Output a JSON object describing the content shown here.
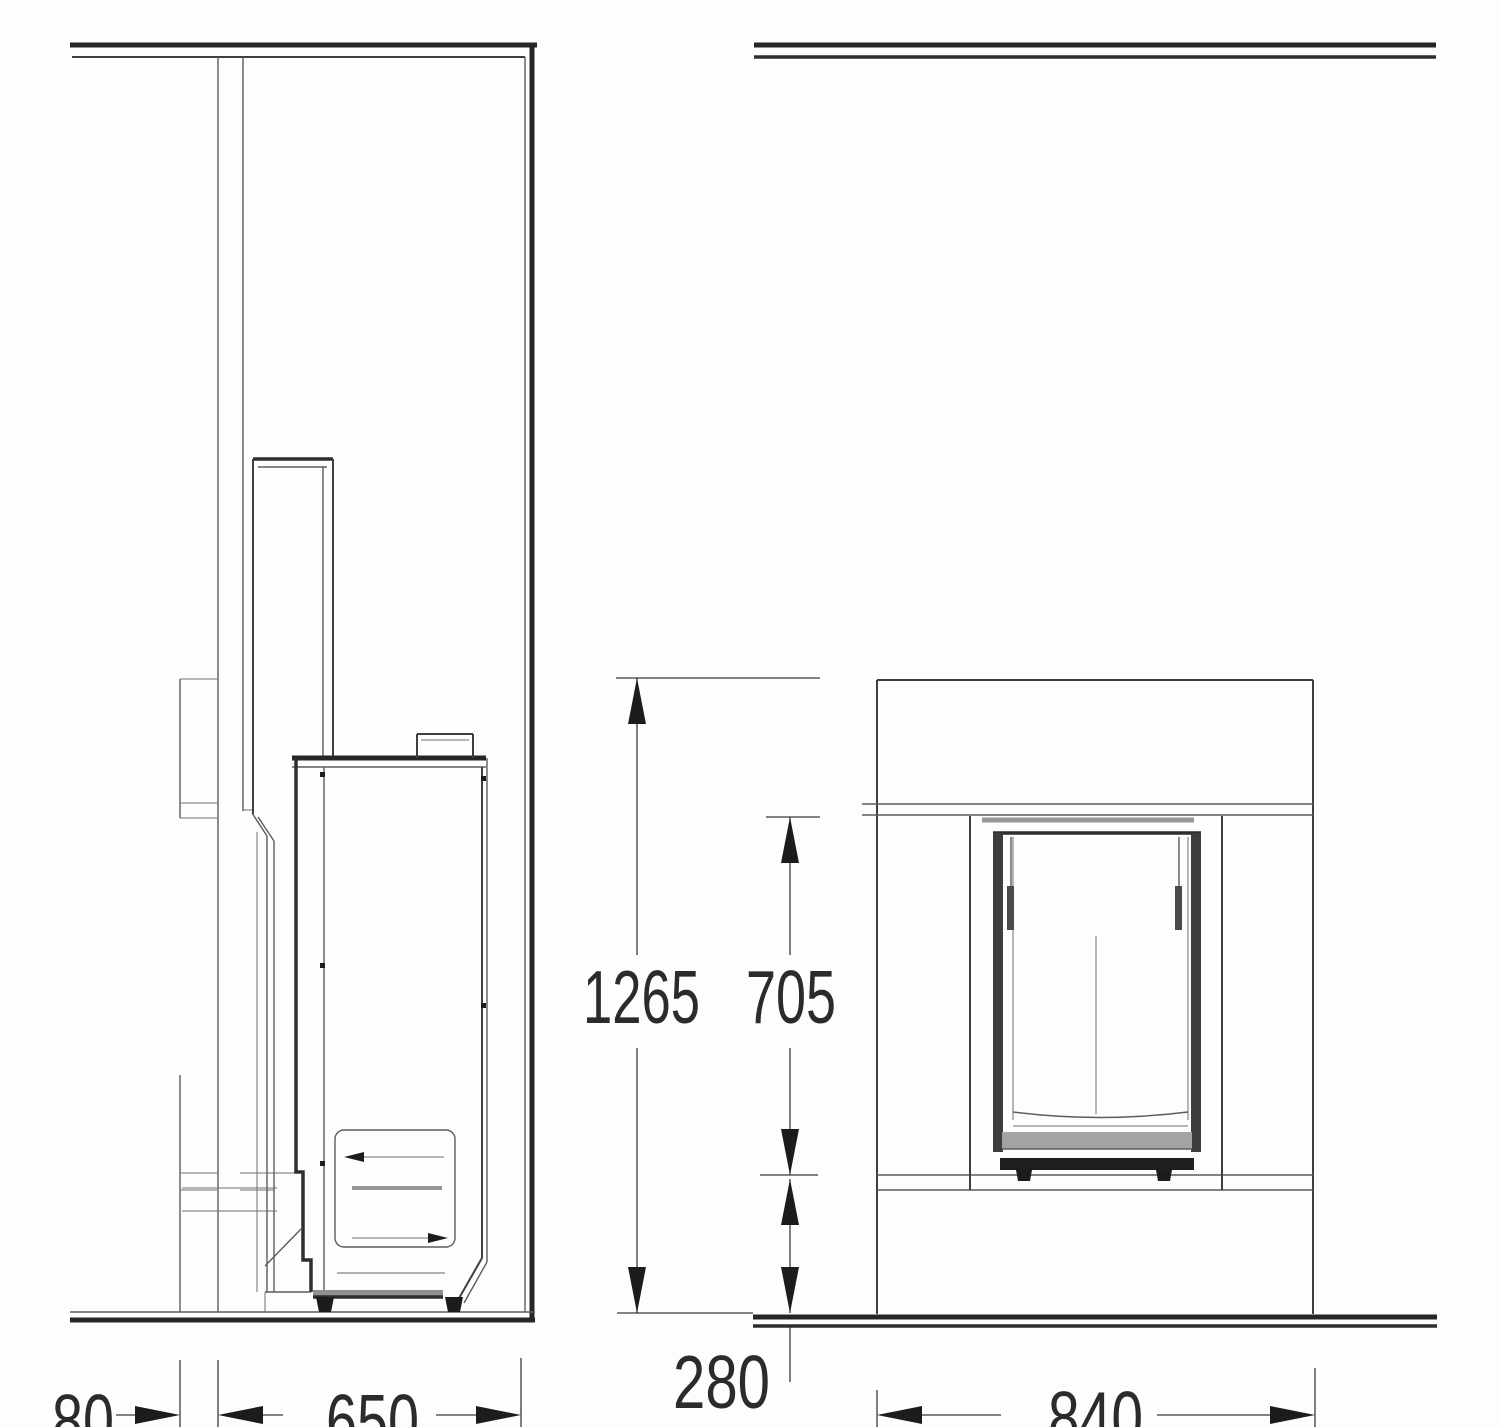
{
  "drawing": {
    "kind": "fireplace installation technical drawing",
    "units": "mm",
    "views": [
      {
        "id": "side-section-view",
        "dimensions": [
          {
            "id": "gap_80",
            "value": "80",
            "meaning": "rear clearance width"
          },
          {
            "id": "depth_650",
            "value": "650",
            "meaning": "unit depth"
          }
        ]
      },
      {
        "id": "front-elevation-view",
        "dimensions": [
          {
            "id": "height_1265",
            "value": "1265",
            "meaning": "overall height above floor"
          },
          {
            "id": "opening_705",
            "value": "705",
            "meaning": "firebox opening height"
          },
          {
            "id": "hearth_280",
            "value": "280",
            "meaning": "hearth height above floor"
          },
          {
            "id": "width_840",
            "value": "840",
            "meaning": "overall width"
          }
        ]
      }
    ]
  },
  "labels": {
    "height_1265": "1265",
    "opening_705": "705",
    "hearth_280": "280",
    "gap_80": "80",
    "depth_650": "650",
    "width_840": "840"
  },
  "colors": {
    "background": "#fdfdfd",
    "line": "#3f3f3f",
    "line_heavy": "#262626",
    "line_light": "#6e6e6e",
    "fill_gray": "#9a9a9a",
    "fill_dark": "#1d1d1d",
    "text": "#2b2b2b"
  }
}
